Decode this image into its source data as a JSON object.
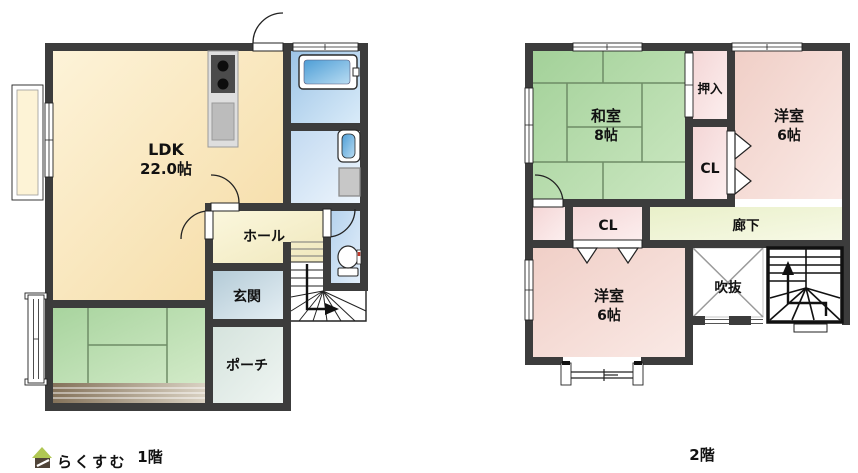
{
  "floor1": {
    "caption": "1階",
    "ldk_label": "LDK",
    "ldk_size": "22.0帖",
    "hall": "ホール",
    "genkan": "玄関",
    "porch": "ポーチ"
  },
  "floor2": {
    "caption": "2階",
    "washitsu_label": "和室",
    "washitsu_size": "8帖",
    "oshiire": "押入",
    "youshitsu_ne_label": "洋室",
    "youshitsu_ne_size": "6帖",
    "cl_ne": "CL",
    "cl_sw": "CL",
    "rouka": "廊下",
    "youshitsu_sw_label": "洋室",
    "youshitsu_sw_size": "6帖",
    "fukinuke": "吹抜"
  },
  "logo": {
    "text": "らくすむ"
  },
  "colors": {
    "wall": "#3c3c3c",
    "ldk": "#f9e6b8",
    "tatami": "#b2d8a8",
    "western_room_pink": "#f3d5cd",
    "bath_blue": "#a2c8e6",
    "corridor": "#eef3d4",
    "logo_text": "#8c7a6c",
    "logo_roof": "#b0c753"
  }
}
